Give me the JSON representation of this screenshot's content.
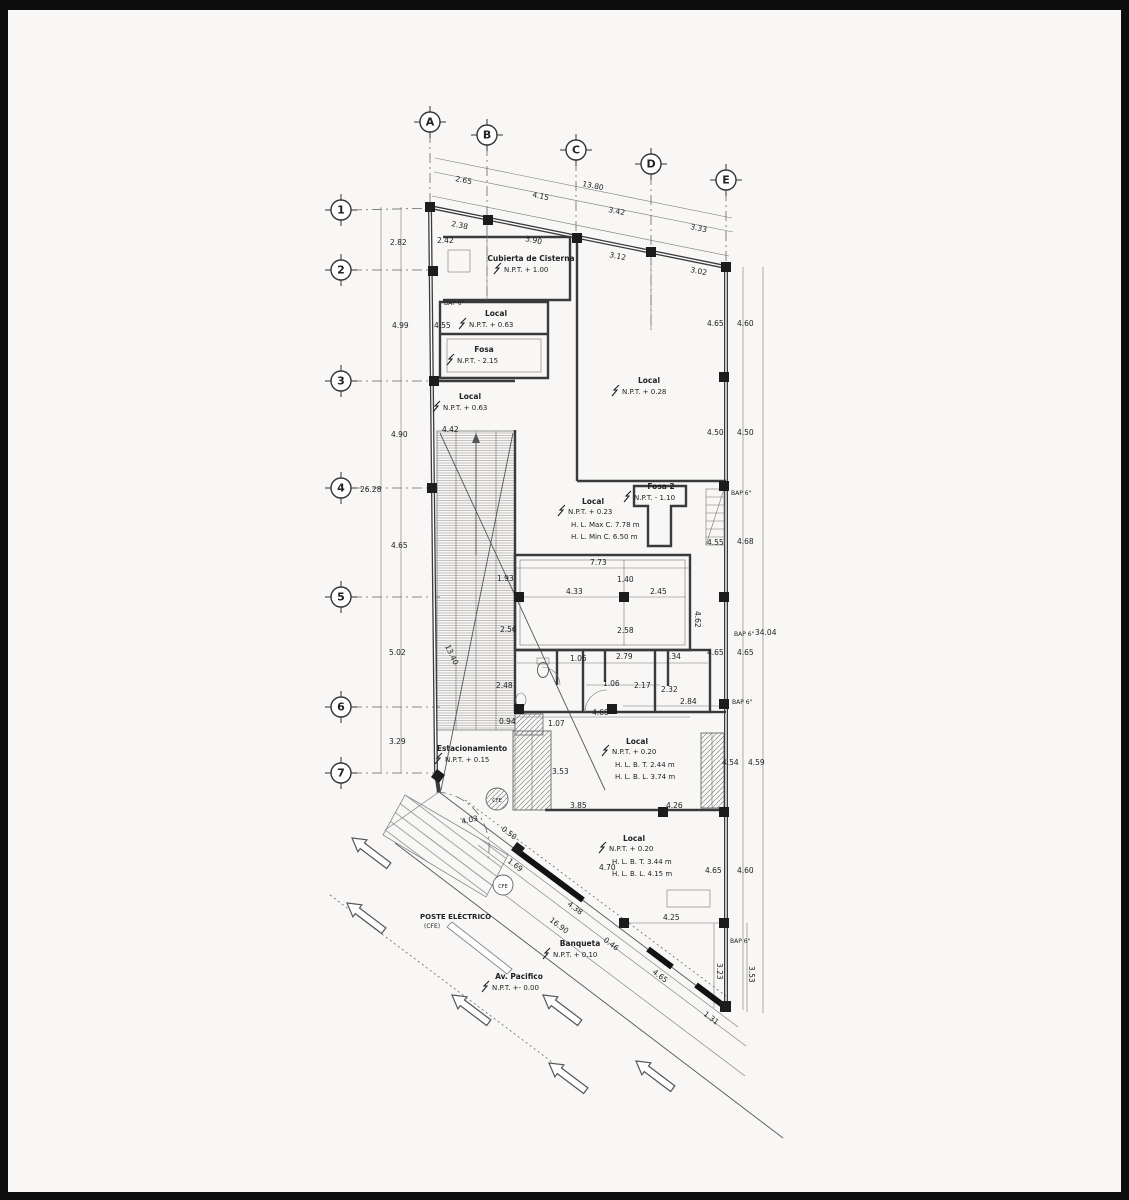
{
  "canvas": {
    "bg": "#f8f7f5",
    "frame": "#0d0d0d"
  },
  "grid": {
    "cols": [
      "A",
      "B",
      "C",
      "D",
      "E"
    ],
    "rows": [
      "1",
      "2",
      "3",
      "4",
      "5",
      "6",
      "7"
    ]
  },
  "rooms": [
    {
      "title": "Cubierta de Cisterna",
      "npt": "N.P.T. + 1.00"
    },
    {
      "title": "Local",
      "npt": "N.P.T. + 0.63"
    },
    {
      "title": "Fosa",
      "npt": "N.P.T. - 2.15"
    },
    {
      "title": "Local",
      "npt": "N.P.T. + 0.28"
    },
    {
      "title": "Local",
      "npt": "N.P.T. + 0.63"
    },
    {
      "title": "Local",
      "npt": "N.P.T. + 0.23",
      "l1": "H. L. Max C. 7.78 m",
      "l2": "H. L. Min C. 6.50 m"
    },
    {
      "title": "Fosa 2",
      "npt": "N.P.T. - 1.10"
    },
    {
      "title": "Estacionamiento",
      "npt": "N.P.T. + 0.15"
    },
    {
      "title": "Local",
      "npt": "N.P.T. + 0.20",
      "l1": "H. L. B. T. 2.44 m",
      "l2": "H. L. B. L. 3.74 m"
    },
    {
      "title": "Local",
      "npt": "N.P.T. + 0.20",
      "l1": "H. L. B. T. 3.44 m",
      "l2": "H. L. B. L. 4.15 m"
    },
    {
      "title": "Banqueta",
      "npt": "N.P.T. + 0.10"
    },
    {
      "title": "Av. Pacifico",
      "npt": "N.P.T. +- 0.00"
    }
  ],
  "notes": {
    "poste": "POSTE ELÉCTRICO",
    "poste_sub": "(CFE)",
    "bap": "BAP 6\"",
    "cfe": "CFE"
  },
  "dims": {
    "top_total": "13.80",
    "top_upper": [
      "2.65",
      "4.15",
      "3.42",
      "3.33"
    ],
    "top_wall": [
      "2.38",
      "3.90",
      "3.12",
      "3.02"
    ],
    "left_chain": [
      "2.82",
      "4.99",
      "4.90",
      "4.65",
      "5.02",
      "3.29"
    ],
    "left_total": "26.28",
    "left_wall": [
      "2.42",
      "4.55",
      "4.42",
      "13.40",
      "2.56",
      "1.93",
      "2.48",
      "0.94"
    ],
    "right_inner": [
      "4.65",
      "4.50",
      "4.55",
      "4.65",
      "4.65"
    ],
    "right_outer": [
      "4.60",
      "4.50",
      "4.68",
      "4.65",
      "4.60"
    ],
    "right_total": "34.04",
    "right_stair": [
      "4.54",
      "4.59"
    ],
    "mezz": [
      "7.73",
      "1.40",
      "4.33",
      "2.45",
      "2.58",
      "4.62"
    ],
    "bath": [
      "1.06",
      "2.79",
      ".34",
      "1.06",
      "2.17",
      "2.32",
      "2.84",
      "4.60",
      "1.07",
      "3.53"
    ],
    "bottom": [
      "3.85",
      "4.26",
      "4.03",
      "0.50",
      "1.69",
      "4.38",
      "16.90",
      "0.46",
      "4.65",
      "4.25",
      "4.70",
      "3.23",
      "3.53",
      "1.31"
    ]
  }
}
